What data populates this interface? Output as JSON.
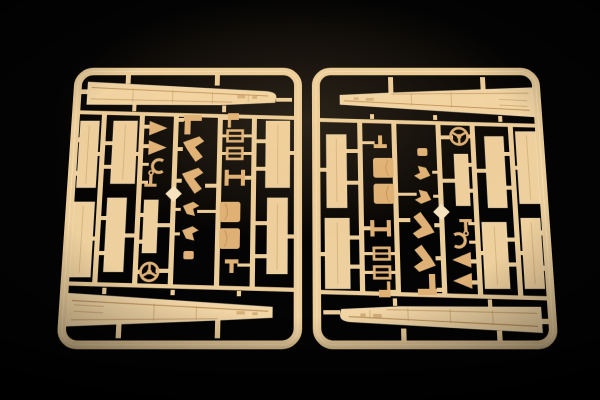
{
  "meta": {
    "type": "photograph",
    "description": "Macro studio photograph of two identical cream-coloured injection-moulded polystyrene sprues (part runners) from a scale model kit, lying side by side on a glossy black backdrop. The right-hand sprue is the same moulding rotated 180 degrees. Each rounded rectangular runner frame carries a long tapered deck strip along its top and bottom edges, tall hull side panels in the outer columns, and a centre grid of small fittings: cradle wedges, a ring, an anchor, a ship's helm wheel, crane davits, crew figures, hatch clamps, an H-frame, curved vent cowls and a bright diamond gate on one runner.",
    "object_count": "2",
    "background": "black studio backdrop"
  },
  "colors": {
    "background": "#040404",
    "plastic": "#ecce9b",
    "deck": "#f1d5a5",
    "panel": "#eed09e",
    "part": "#dfb176",
    "detail-line": "#b98f58",
    "junction": "#f6e4c0",
    "edge-highlight": "rgba(255,246,226,0.35)"
  },
  "sprues": [
    {
      "id": "sprue-left",
      "label": "Sprue copy 1 (upright)"
    },
    {
      "id": "sprue-right",
      "label": "Sprue copy 2 (rotated 180 degrees)"
    }
  ],
  "parts_inventory": [
    "tapered deck strip (upper)",
    "tapered deck strip (lower)",
    "hull side panels x7",
    "boat cradle wedges x2",
    "ring fitting",
    "anchor",
    "narrow hatch panel",
    "ship's helm wheel",
    "flag bracket",
    "crane davits x2",
    "crew figures x2",
    "signal flag post",
    "hatch clamps x2",
    "H-frame spreader",
    "curved vent cowls x2",
    "T-fitting",
    "diamond sprue gate"
  ]
}
